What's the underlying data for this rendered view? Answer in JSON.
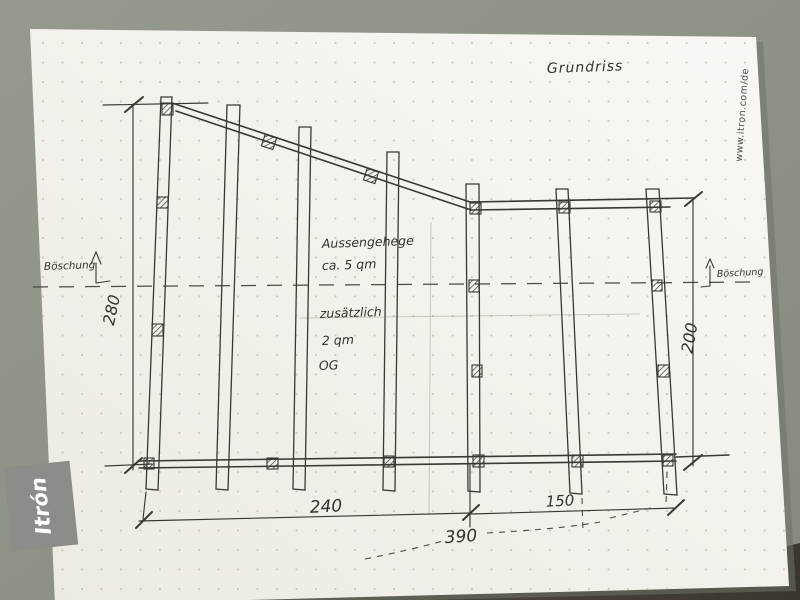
{
  "title": "Grundriss",
  "watermark": "www.itron.com/de",
  "logo": {
    "text": "Itrón"
  },
  "notes": {
    "enclosure_line1": "Aussengehege",
    "enclosure_line2": "ca. 5 qm",
    "additional_line1": "zusätzlich",
    "additional_line2": "2 qm",
    "additional_line3": "OG"
  },
  "labels": {
    "slope_left": "Böschung",
    "slope_right": "Böschung"
  },
  "dimensions": {
    "left_height": "280",
    "right_height": "200",
    "bottom_left_width": "240",
    "bottom_right_width": "150",
    "overall_width": "390"
  },
  "colors": {
    "desk": "#8e9389",
    "desk_dark": "#46413a",
    "paper": "#f5f3ee",
    "pencil": "#3b3834",
    "logo_bg": "#8c8c88",
    "logo_fg": "#ffffff"
  }
}
